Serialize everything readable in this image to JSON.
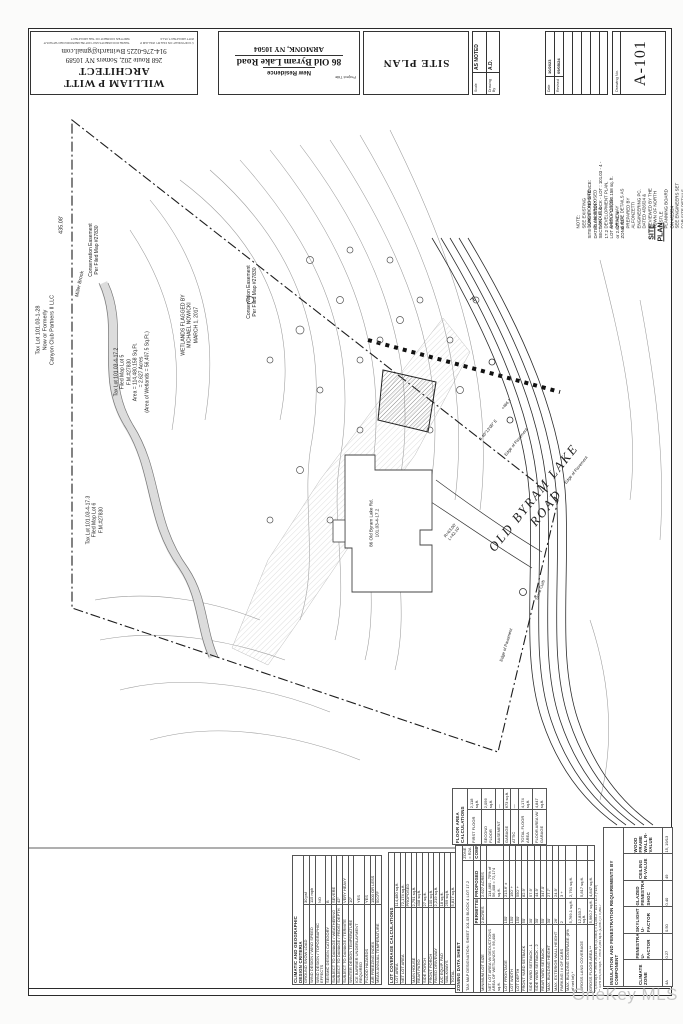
{
  "title_block": {
    "architect": {
      "name": "WILLIAM P WITT ARCHITECT",
      "address": "268 Route 202, Somers NY 10589",
      "contact": "914-276-0225 Bwittarch@gmail.com",
      "copyright_1": "© COPYRIGHT ON FILE BY WILLIAM P WITT ARCHITECT, PLLC",
      "copyright_2": "THESE DOCUMENTS MAY NOT BE REPRODUCED WITHOUT WRITTEN CONSENT OF THE ARCHITECT"
    },
    "project": {
      "label": "Project Title",
      "type": "New Residence",
      "address_line1": "86 Old Byram Lake Road",
      "address_line2": "ARMONK, NY 10504"
    },
    "sheet_title": "SITE PLAN",
    "scale": {
      "label": "Scale",
      "value": "AS NOTED"
    },
    "drawn_by": {
      "label": "Drawing By",
      "value": "A.D."
    },
    "date": {
      "label": "Date",
      "value": "10/2023"
    },
    "revised": {
      "label": "Revised",
      "value": "09/05/24"
    },
    "drawing_no": {
      "label": "Drawing No.",
      "value": "A-101"
    }
  },
  "plan": {
    "labels": [
      {
        "name": "road-name",
        "text": "OLD  BYRAM  LAKE  ROAD",
        "x": 540,
        "y": 503,
        "rot": -51,
        "fs": 13,
        "serif": 1,
        "ls": 2
      },
      {
        "name": "tax-lot-101-03-1-28",
        "text": "Tax Lot 101.03-1-28\nNow or Formerly\nCanyon Club Partners II LLC",
        "x": 46,
        "y": 330,
        "rot": -90,
        "fs": 5.5
      },
      {
        "name": "boundary-dim-435",
        "text": "435.08'",
        "x": 62,
        "y": 225,
        "rot": -90,
        "fs": 5.5
      },
      {
        "name": "conservation-easement-1",
        "text": "Conservation Easement\nPer Filed Map #27830",
        "x": 94,
        "y": 250,
        "rot": -90,
        "fs": 5
      },
      {
        "name": "conservation-easement-2",
        "text": "Conservation Easement\nPer Filed Map #27830",
        "x": 252,
        "y": 292,
        "rot": -90,
        "fs": 5
      },
      {
        "name": "miller-brook",
        "text": "Miller Brook",
        "x": 80,
        "y": 284,
        "rot": -78,
        "fs": 5
      },
      {
        "name": "tax-lot-101-03-4-17-2",
        "text": "Tax Lot 101.03-4-17.2\nFiled Map Lot 5\nF.M.#27830\nArea = 114,480.158 Sq.Ft.\n= 2.627 Acres\n(Area of Wetlands = 56,407.5 Sq.Ft.)",
        "x": 132,
        "y": 372,
        "rot": -90,
        "fs": 5
      },
      {
        "name": "wetlands-flagged",
        "text": "WETLANDS FLAGGED BY\nMICHAEL NOWICKI\nMARCH 1, 2017",
        "x": 190,
        "y": 325,
        "rot": -90,
        "fs": 5
      },
      {
        "name": "tax-lot-101-03-4-17-3",
        "text": "Tax Lot 101.03-4-17.3\nFiled Map Lot 6\nF.M.#27830",
        "x": 95,
        "y": 520,
        "rot": -90,
        "fs": 5
      },
      {
        "name": "house-address",
        "text": "86 Old Byram Lake Rd.\n101.03-4-17.2",
        "x": 374,
        "y": 523,
        "rot": -90,
        "fs": 4.6
      },
      {
        "name": "edge-of-pavement-1",
        "text": "Edge of Pavement",
        "x": 516,
        "y": 442,
        "rot": -51,
        "fs": 4.2
      },
      {
        "name": "edge-of-pavement-2",
        "text": "Edge of Pavement",
        "x": 576,
        "y": 470,
        "rot": -51,
        "fs": 4.2
      },
      {
        "name": "edge-of-pavement-3",
        "text": "Edge of Pavement",
        "x": 506,
        "y": 645,
        "rot": -73,
        "fs": 4.2
      },
      {
        "name": "stone-curb",
        "text": "Stone Curb",
        "x": 540,
        "y": 590,
        "rot": -70,
        "fs": 4.2
      },
      {
        "name": "curve-data",
        "text": "R=63.00'\nL=42.10'",
        "x": 452,
        "y": 532,
        "rot": -51,
        "fs": 4.2
      },
      {
        "name": "road-bearing",
        "text": "S 40°13'00\" E",
        "x": 488,
        "y": 430,
        "rot": -51,
        "fs": 4.2
      },
      {
        "name": "spot-elevation",
        "text": "+466.1",
        "x": 506,
        "y": 404,
        "rot": -51,
        "fs": 4
      },
      {
        "name": "site-plan-callout",
        "text": "SITE PLAN",
        "x": 657,
        "y": 232,
        "rot": -90,
        "fs": 7,
        "bold": 1,
        "underline": 1
      },
      {
        "name": "survey-reference",
        "text": "SITE SURVEY REFERENCE:\nDATED  08/05/2017\nSECTION - BLOCK - LOT :  101.03 - 4 - 17.2\nLOT AREA  =  114,480.158 sq. ft.\nor  2.627 Ac. ±\nZONE   R2A",
        "x": 606,
        "y": 200,
        "rot": -90,
        "fs": 4.4,
        "align": "left"
      },
      {
        "name": "plan-note",
        "text": "NOTE:\nSEE EXISTING CONDITIONS SITE PLAN, PROPOSED\nLAYOUT & DEVELOPMENT PLAN, & PROPOSED DRIVEWAY\n& SITE DETAILS AS PREPARED BY ALFONZETTI ENGINEERING PC.\nDATED 4/26/24 & REVIEWED BY THE TOWN OF NORTH CASTLE\nPLANNING BOARD ON 4/25/24\nSEE ENGINEERS SET FOR SITE DETAILS, PROTECTION & DRAINAGE",
        "x": 636,
        "y": 205,
        "rot": -90,
        "fs": 4.4,
        "align": "left"
      }
    ]
  },
  "tables": {
    "climatic": {
      "title": "CLIMATIC AND GEOGRAPHIC\nDESIGN CRITERIA",
      "rows": [
        [
          "GROUND SNOW LOAD",
          "30 psf"
        ],
        [
          "WIND DESIGN / WIND SPEED",
          "115 mph"
        ],
        [
          "WIND DESIGN / TOPOGRAPHIC EFFECTS",
          "NO"
        ],
        [
          "SEISMIC DESIGN CATEGORY",
          "B"
        ],
        [
          "SUBJECT TO DAMAGE / WEATHERING",
          "SEVERE"
        ],
        [
          "SUBJECT TO DAMAGE / FROST DEPTH",
          "42\""
        ],
        [
          "SUBJECT TO DAMAGE / TERMITE",
          "VERY HEAVY"
        ],
        [
          "WINTER DESIGN TEMPERATURE",
          "10°"
        ],
        [
          "ICE BARRIER UNDERLAYMENT REQUIRED",
          "YES"
        ],
        [
          "FLOOD HAZARDS",
          "YES"
        ],
        [
          "AIR FREEZING INDEX",
          "1500 OR LESS"
        ],
        [
          "MEAN ANNUAL TEMPERATURE",
          "50.0°F"
        ]
      ]
    },
    "lot_coverage": {
      "title": "LOT COVERAGE CALCULATIONS",
      "rows": [
        [
          "LOT AREA",
          "114,480 sq.ft."
        ],
        [
          "NET LOT AREA",
          "72,174 sq.ft."
        ],
        [
          "",
          "PROPOSED"
        ],
        [
          "MAIN HOUSE",
          "2,791 sq.ft."
        ],
        [
          "REAR PATIO",
          "408 sq.ft."
        ],
        [
          "SIDE PORCH",
          "27 sq.ft."
        ],
        [
          "FRONT PORCH",
          "100 sq.ft."
        ],
        [
          "PAVED DRIVEWAY",
          "2,219 sq.ft."
        ],
        [
          "A/C EQUIP. PAD",
          "18 sq.ft."
        ],
        [
          "WALKWAYS",
          "259 sq.ft."
        ],
        [
          "TOTAL",
          "5,817 sq.ft."
        ]
      ]
    },
    "floor_area": {
      "title": "FLOOR AREA CALCULATIONS",
      "rows": [
        [
          "FIRST FLOOR",
          "2,118 sq.ft."
        ],
        [
          "SECOND FLOOR",
          "2,056 sq.ft."
        ],
        [
          "BASEMENT",
          "—"
        ],
        [
          "GARAGE",
          "673 sq.ft."
        ],
        [
          "ATTIC",
          "—"
        ],
        [
          "TOTAL FLOOR AREA",
          "4,174 sq.ft."
        ],
        [
          "FLOOR AREA W/ GARAGE",
          "4,847 sq.ft."
        ]
      ]
    },
    "zoning": {
      "title": "ZONING DATA SHEET",
      "subtitle": "TAX MAP DESIGNATION:   SHEET 101.03   BLOCK 4   LOT 17.2",
      "zone_note": "ZONE = R2A",
      "columns": [
        "",
        "PERMITTED",
        "PROPOSED",
        "COMPLIES"
      ],
      "rows": [
        [
          "MINIMUM LOT SIZE",
          "2 ACRES",
          "2.627 ACRES",
          ""
        ],
        [
          "NET LOT AREA W/ DEDUCTIONS\nAREA OF WETLANDS = 56,408 sq.ft.",
          "",
          "114,480 - 75% of 56,408 = 72,174 sq.ft.",
          ""
        ],
        [
          "LOT FRONTAGE",
          "150'",
          "213.6' ±",
          ""
        ],
        [
          "LOT WIDTH",
          "150'",
          "150' +",
          ""
        ],
        [
          "LOT DEPTH",
          "150'",
          "550' +",
          ""
        ],
        [
          "FRONT YARD SETBACK",
          "50'",
          "82.9'",
          ""
        ],
        [
          "SIDE YARD SETBACK - 1",
          "30'",
          "57.9'",
          ""
        ],
        [
          "SIDE YARD SETBACK - 2",
          "30'",
          "44.9'",
          ""
        ],
        [
          "REAR YARD SETBACK",
          "50'",
          "347.0'",
          ""
        ],
        [
          "MAX. BUILDING HEIGHT",
          "30'",
          "27.7'",
          ""
        ],
        [
          "MAX. EXTERIOR WALL HEIGHT",
          "26'",
          "24.9'",
          ""
        ],
        [
          "PARKING / # OF CARS",
          "2",
          "3 +",
          ""
        ],
        [
          "MAX. BUILDING COVERAGE (8% of net lot) *",
          "5,769.1 sq.ft.",
          "2,791 sq.ft.",
          ""
        ],
        [
          "GROSS LAND COVERAGE",
          "12,833.7 sq.ft.",
          "5,817 sq.ft.",
          ""
        ],
        [
          "GROSS FLOOR AREA **",
          "5,960.7 sq.ft.",
          "4,847 sq.ft.",
          ""
        ]
      ],
      "notes": [
        "* 3,350 sq.ft. + 3% of 26,314 sq.ft. (2,546.3) = 11,084.2 + 101 = 12.3 (+145)",
        "** 4.5% of 6,534 sq.ft. + 5% of 2,584 sq.ft. (1,556.7) = 5,960.7"
      ]
    },
    "insulation": {
      "title": "INSULATION AND FENESTRATION REQUIREMENTS BY COMPONENT",
      "columns": [
        "CLIMATE ZONE",
        "FENESTRATION U-FACTOR",
        "SKYLIGHT U-FACTOR",
        "GLAZED FENESTRATION SHGC",
        "CEILING R-VALUE",
        "WOOD FRAME WALL R-VALUE"
      ],
      "values": [
        "4A",
        "0.27",
        "0.50",
        "0.40",
        "49",
        "15, 19/13"
      ]
    }
  },
  "watermark": "OneKey MLS"
}
